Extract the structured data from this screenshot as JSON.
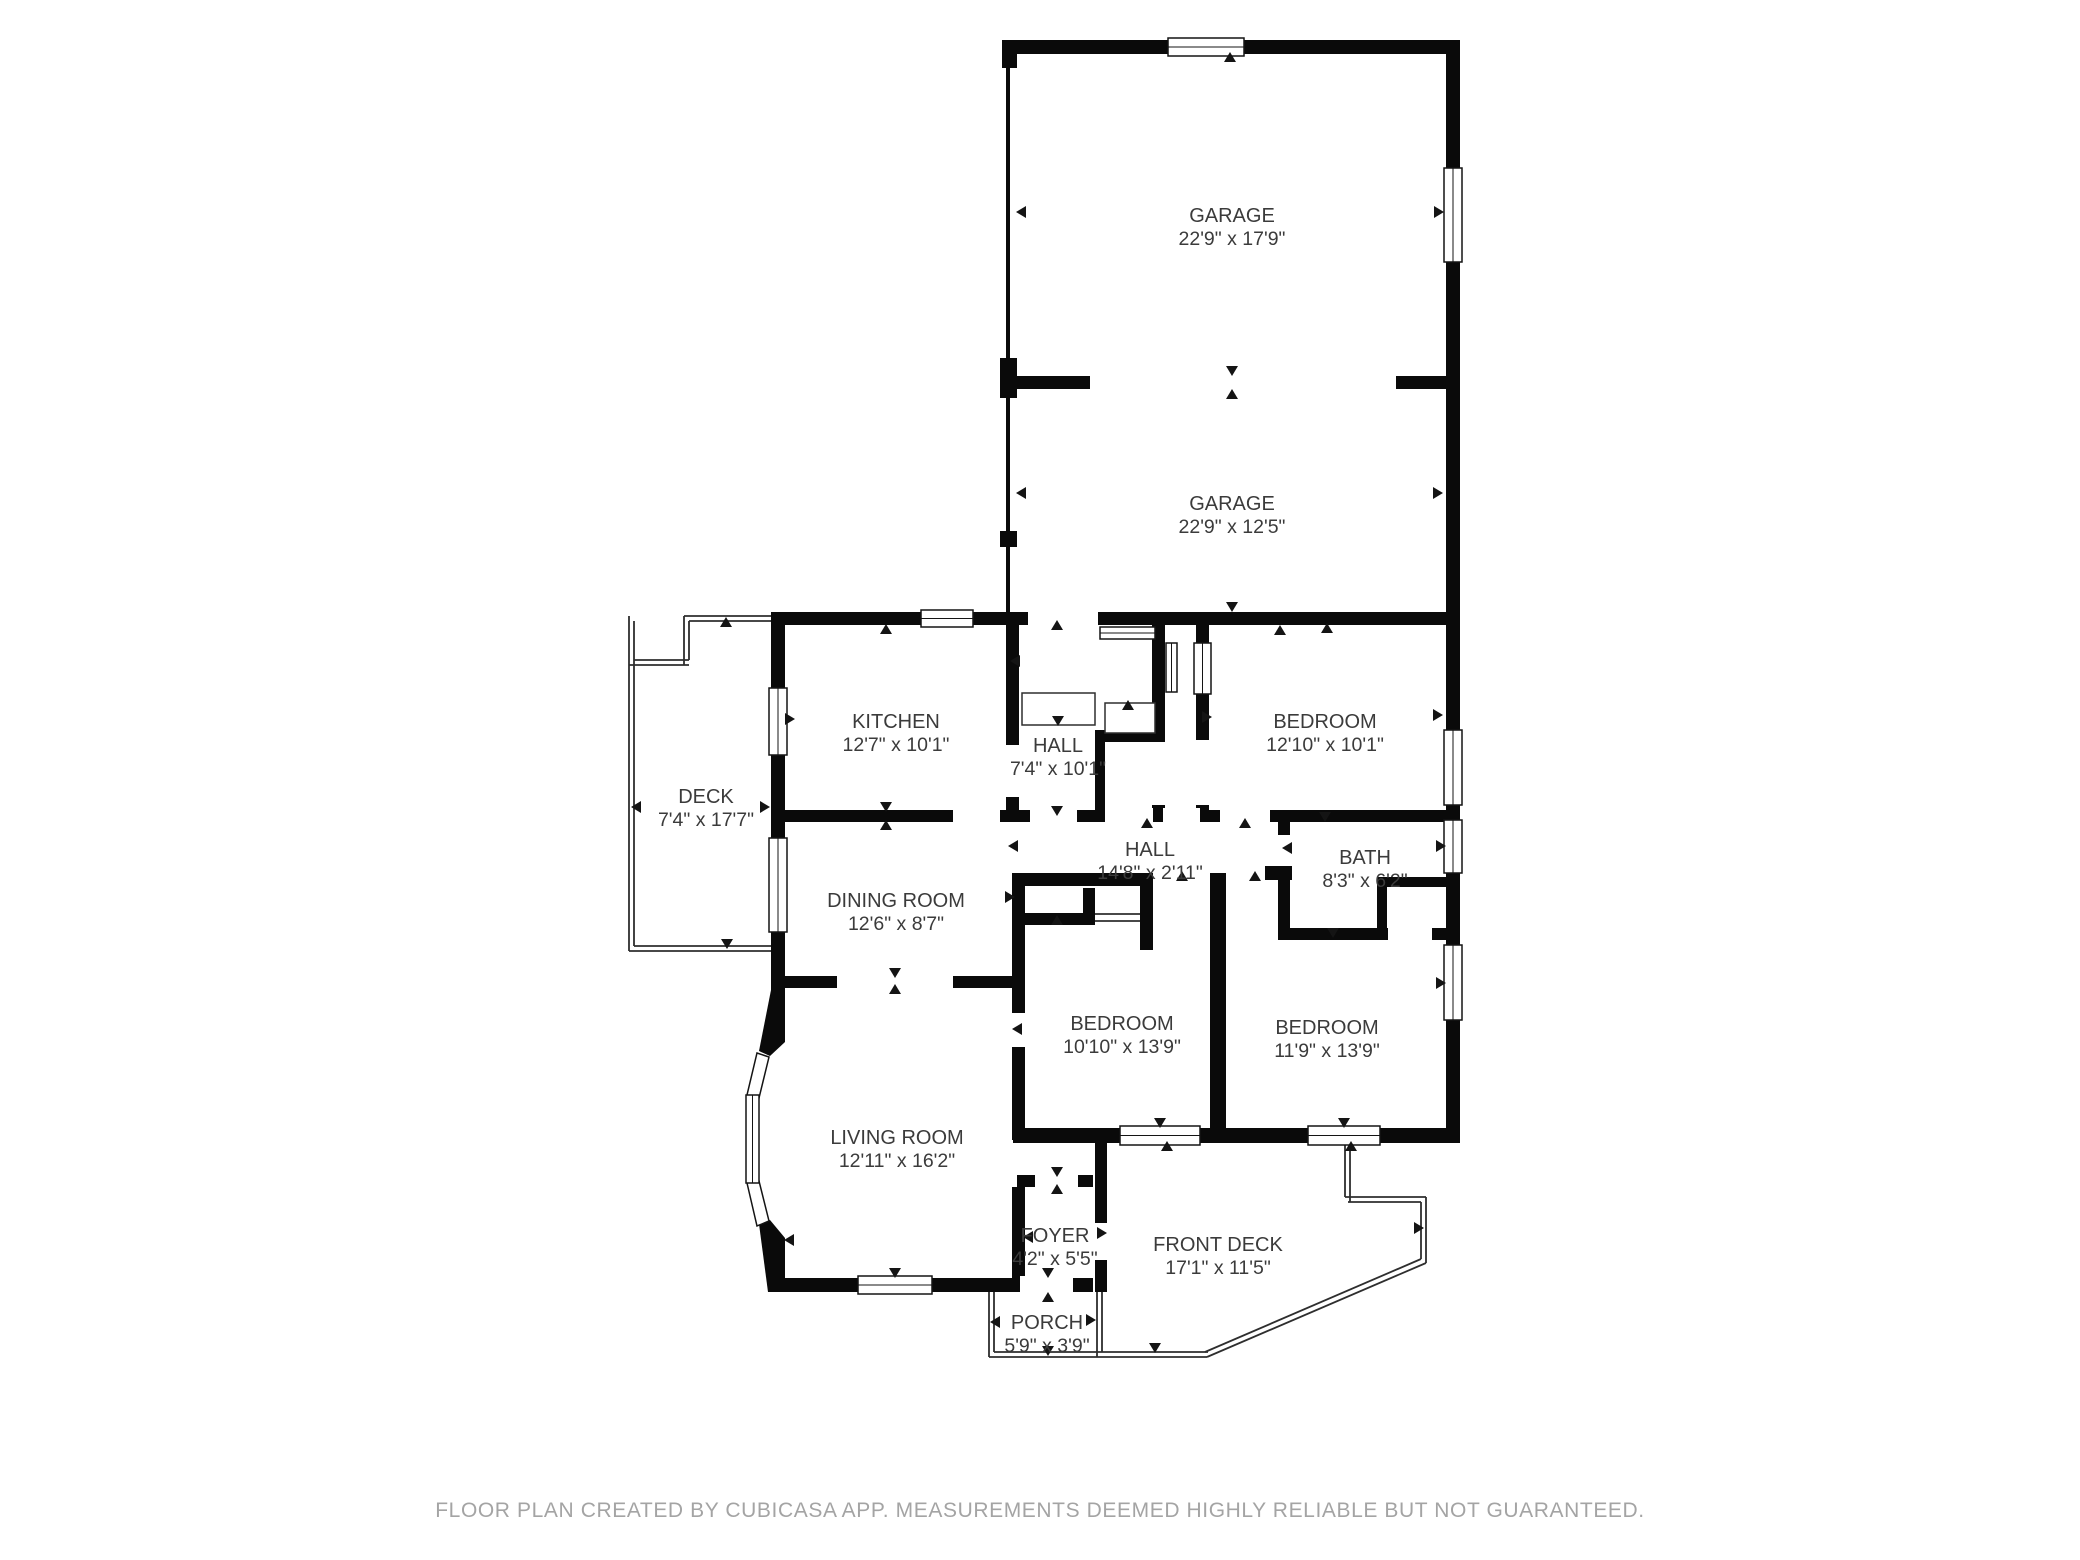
{
  "plan": {
    "type": "floor-plan",
    "source_note": "FLOOR PLAN CREATED BY CUBICASA APP. MEASUREMENTS DEEMED HIGHLY RELIABLE BUT NOT GUARANTEED."
  },
  "rooms": [
    {
      "name": "GARAGE",
      "dims": "22'9\" x 17'9\""
    },
    {
      "name": "GARAGE",
      "dims": "22'9\" x 12'5\""
    },
    {
      "name": "KITCHEN",
      "dims": "12'7\" x 10'1\""
    },
    {
      "name": "HALL",
      "dims": "7'4\" x 10'1\""
    },
    {
      "name": "BEDROOM",
      "dims": "12'10\" x 10'1\""
    },
    {
      "name": "DECK",
      "dims": "7'4\" x 17'7\""
    },
    {
      "name": "HALL",
      "dims": "14'8\" x 2'11\""
    },
    {
      "name": "BATH",
      "dims": "8'3\" x 6'2\""
    },
    {
      "name": "DINING ROOM",
      "dims": "12'6\" x 8'7\""
    },
    {
      "name": "BEDROOM",
      "dims": "10'10\" x 13'9\""
    },
    {
      "name": "BEDROOM",
      "dims": "11'9\" x 13'9\""
    },
    {
      "name": "LIVING ROOM",
      "dims": "12'11\" x 16'2\""
    },
    {
      "name": "FOYER",
      "dims": "4'2\" x 5'5\""
    },
    {
      "name": "FRONT DECK",
      "dims": "17'1\" x 11'5\""
    },
    {
      "name": "PORCH",
      "dims": "5'9\" x 3'9\""
    }
  ],
  "footer": {
    "text": "FLOOR PLAN CREATED BY CUBICASA APP. MEASUREMENTS DEEMED HIGHLY RELIABLE BUT NOT GUARANTEED."
  },
  "colors": {
    "wall": "#0a0a0a",
    "label": "#3b3b3b",
    "footer_text": "#a4a4a4",
    "background": "#ffffff"
  }
}
